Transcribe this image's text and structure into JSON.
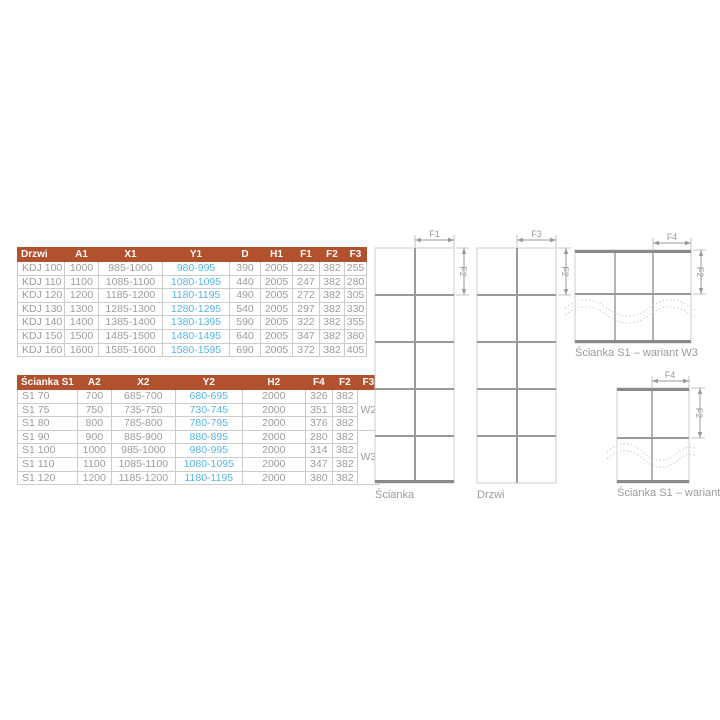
{
  "colors": {
    "header_bg": "#b1512d",
    "header_text": "#ffffff",
    "cell_text": "#9c9c9c",
    "highlight_text": "#55b6e8",
    "table_border": "#cccccc",
    "line_thin": "#cccccc",
    "line_medium": "#9a9a9a",
    "line_thick": "#8a8a8a"
  },
  "table_drzwi": {
    "columns": [
      "Drzwi",
      "A1",
      "X1",
      "Y1",
      "D",
      "H1",
      "F1",
      "F2",
      "F3"
    ],
    "rows": [
      [
        "KDJ 100",
        "1000",
        "985-1000",
        "980-995",
        "390",
        "2005",
        "222",
        "382",
        "255"
      ],
      [
        "KDJ 110",
        "1100",
        "1085-1100",
        "1080-1095",
        "440",
        "2005",
        "247",
        "382",
        "280"
      ],
      [
        "KDJ 120",
        "1200",
        "1185-1200",
        "1180-1195",
        "490",
        "2005",
        "272",
        "382",
        "305"
      ],
      [
        "KDJ 130",
        "1300",
        "1285-1300",
        "1280-1295",
        "540",
        "2005",
        "297",
        "382",
        "330"
      ],
      [
        "KDJ 140",
        "1400",
        "1385-1400",
        "1380-1395",
        "590",
        "2005",
        "322",
        "382",
        "355"
      ],
      [
        "KDJ 150",
        "1500",
        "1485-1500",
        "1480-1495",
        "640",
        "2005",
        "347",
        "382",
        "380"
      ],
      [
        "KDJ 160",
        "1600",
        "1585-1600",
        "1580-1595",
        "690",
        "2005",
        "372",
        "382",
        "405"
      ]
    ]
  },
  "table_scianka": {
    "columns": [
      "Ścianka S1",
      "A2",
      "X2",
      "Y2",
      "H2",
      "F4",
      "F2",
      "F3"
    ],
    "rows": [
      [
        "S1 70",
        "700",
        "685-700",
        "680-695",
        "2000",
        "326",
        "382"
      ],
      [
        "S1 75",
        "750",
        "735-750",
        "730-745",
        "2000",
        "351",
        "382"
      ],
      [
        "S1 80",
        "800",
        "785-800",
        "780-795",
        "2000",
        "376",
        "382"
      ],
      [
        "S1 90",
        "900",
        "885-900",
        "880-895",
        "2000",
        "280",
        "382"
      ],
      [
        "S1 100",
        "1000",
        "985-1000",
        "980-995",
        "2000",
        "314",
        "382"
      ],
      [
        "S1 110",
        "1100",
        "1085-1100",
        "1080-1095",
        "2000",
        "347",
        "382"
      ],
      [
        "S1 120",
        "1200",
        "1185-1200",
        "1180-1195",
        "2000",
        "380",
        "382"
      ]
    ],
    "variant_groups": [
      {
        "label": "W2",
        "span": 3
      },
      {
        "label": "W3",
        "span": 4
      }
    ]
  },
  "diagrams": {
    "scianka": {
      "caption": "Ścianka",
      "dim_top": "F1",
      "dim_side": "F2"
    },
    "drzwi": {
      "caption": "Drzwi",
      "dim_top": "F3",
      "dim_side": "F2"
    },
    "w3": {
      "caption": "Ścianka S1 – wariant W3",
      "dim_top": "F4",
      "dim_side": "F2"
    },
    "w2": {
      "caption": "Ścianka S1 – wariant W2",
      "dim_top": "F4",
      "dim_side": "F2"
    }
  }
}
